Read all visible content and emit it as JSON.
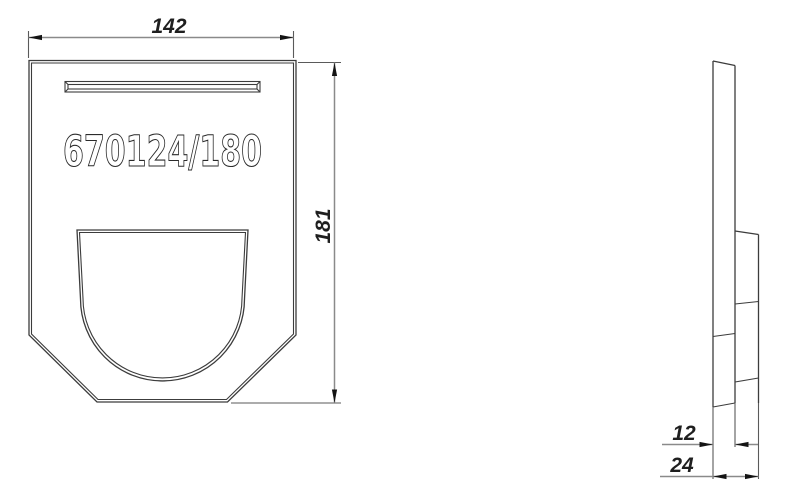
{
  "drawing": {
    "part_number": "670124/180",
    "dimensions": {
      "width": "142",
      "height": "181",
      "thickness_plate": "12",
      "thickness_total": "24"
    },
    "colors": {
      "outline": "#3c3c3c",
      "inner_edge": "#4a4a4a",
      "dimension_line": "#8a8a8a",
      "extension_line": "#5a5a5a",
      "arrow": "#141414",
      "text": "#1f1f1f",
      "background": "#ffffff"
    }
  }
}
